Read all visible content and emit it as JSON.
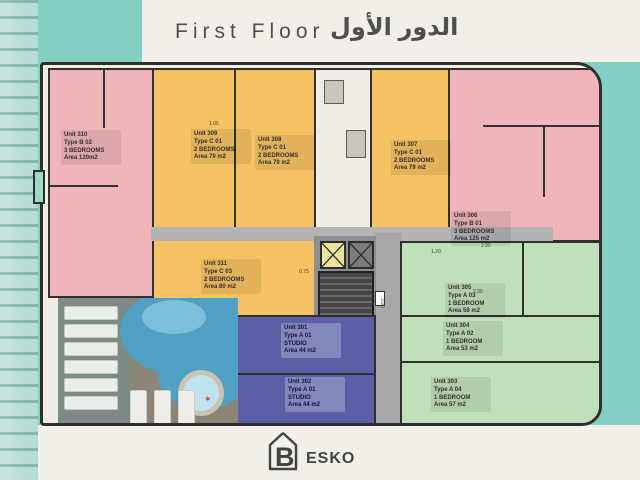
{
  "title": {
    "en": "First Floor",
    "ar": "الدور الأول"
  },
  "brand": {
    "letter": "B",
    "name": "ESKO"
  },
  "units": [
    {
      "name": "Unit 310",
      "type": "Type B 02",
      "rooms": "3 BEDROOMS",
      "area": "Area 120m2",
      "color": "#efb5ba"
    },
    {
      "name": "Unit 309",
      "type": "Type C 01",
      "rooms": "2 BEDROOMS",
      "area": "Area 79 m2",
      "color": "#f6c263"
    },
    {
      "name": "Unit 308",
      "type": "Type C 01",
      "rooms": "2 BEDROOMS",
      "area": "Area 79 m2",
      "color": "#f6c263"
    },
    {
      "name": "Unit 307",
      "type": "Type C 01",
      "rooms": "2 BEDROOMS",
      "area": "Area 79 m2",
      "color": "#f6c263"
    },
    {
      "name": "Unit 306",
      "type": "Type B 01",
      "rooms": "3 BEDROOMS",
      "area": "Area 125 m2",
      "color": "#efb5ba"
    },
    {
      "name": "Unit 311",
      "type": "Type C 03",
      "rooms": "2 BEDROOMS",
      "area": "Area 80 m2",
      "color": "#f6c263"
    },
    {
      "name": "Unit 305",
      "type": "Type A 03",
      "rooms": "1 BEDROOM",
      "area": "Area 58 m2",
      "color": "#c0e0ba"
    },
    {
      "name": "Unit 304",
      "type": "Type A 02",
      "rooms": "1 BEDROOM",
      "area": "Area 53 m2",
      "color": "#c0e0ba"
    },
    {
      "name": "Unit 303",
      "type": "Type A 04",
      "rooms": "1 BEDROOM",
      "area": "Area 57 m2",
      "color": "#c0e0ba"
    },
    {
      "name": "Unit 301",
      "type": "Type A 01",
      "rooms": "STUDIO",
      "area": "Area 44 m2",
      "color": "#5a5fa6"
    },
    {
      "name": "Unit 302",
      "type": "Type A 01",
      "rooms": "STUDIO",
      "area": "Area 44 m2",
      "color": "#5a5fa6"
    }
  ],
  "dimensions": [
    "3.90",
    "2.90",
    "1.20",
    "2.30",
    "1.05",
    "0.75"
  ],
  "colors": {
    "background_teal": "#84cec3",
    "paper_cream": "#f1efe8",
    "unit_pink": "#efb5ba",
    "unit_yellow": "#f6c263",
    "unit_green": "#c0e0ba",
    "unit_blue": "#5a5fa6",
    "corridor_gray": "#b3b3b3",
    "wall_dark": "#303030",
    "pool_water": "#4fa0c4",
    "logo_dark": "#3d453f"
  }
}
